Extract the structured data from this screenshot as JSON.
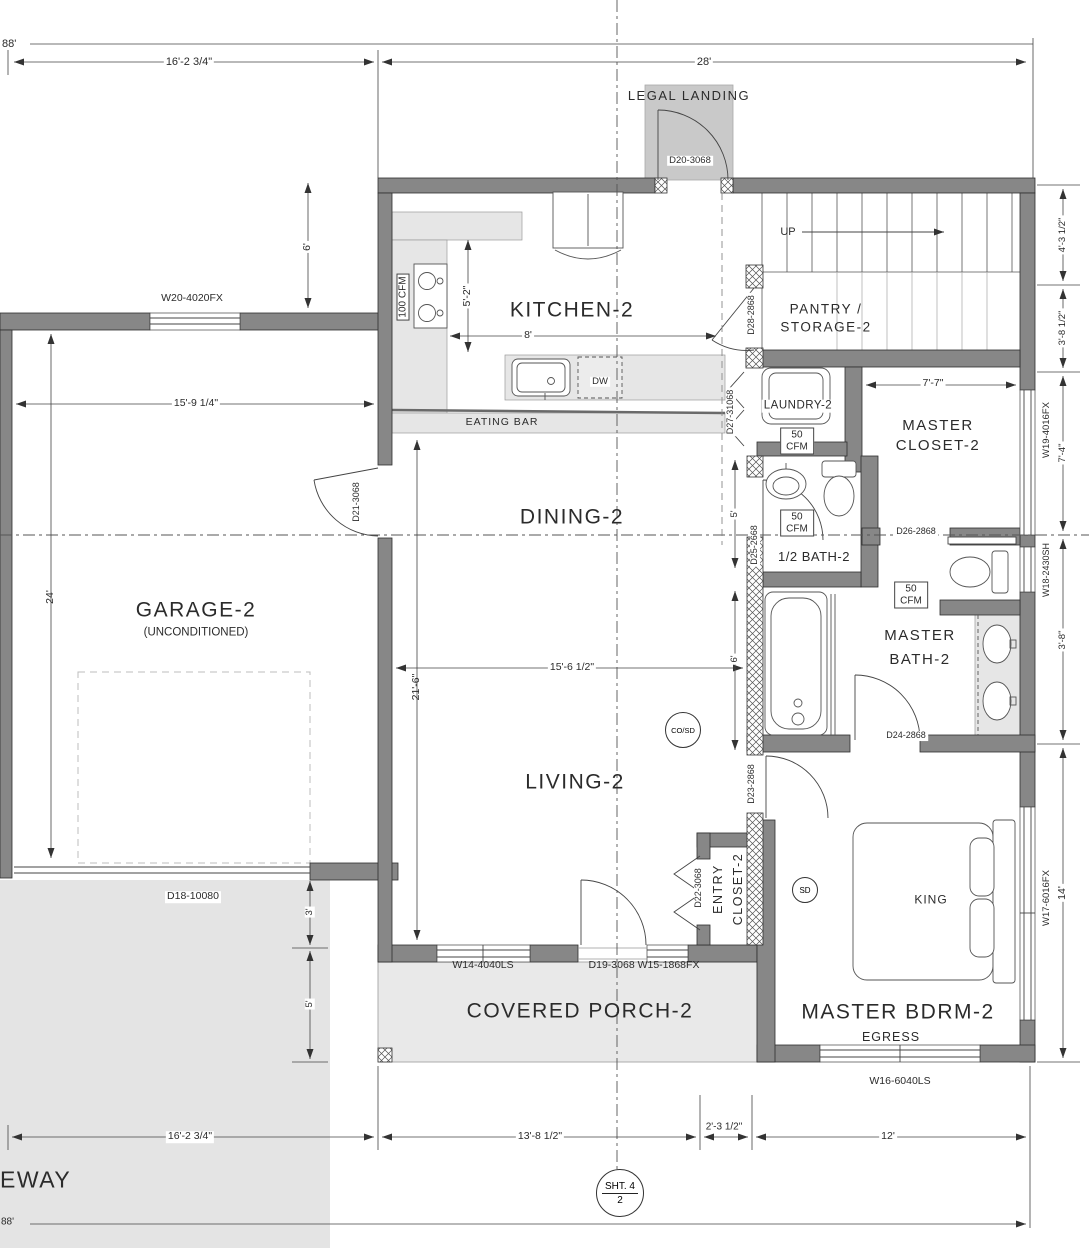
{
  "colors": {
    "wall": "#878787",
    "light_fill": "#e6e6e6",
    "landing_fill": "#c9c9c9",
    "driveway_fill": "#e4e4e4",
    "line": "#3c3c3c"
  },
  "rooms": {
    "kitchen": "KITCHEN-2",
    "pantry_line1": "PANTRY /",
    "pantry_line2": "STORAGE-2",
    "laundry": "LAUNDRY-2",
    "master_closet_line1": "MASTER",
    "master_closet_line2": "CLOSET-2",
    "half_bath": "1/2 BATH-2",
    "master_bath_line1": "MASTER",
    "master_bath_line2": "BATH-2",
    "dining": "DINING-2",
    "garage": "GARAGE-2",
    "garage_sub": "(UNCONDITIONED)",
    "living": "LIVING-2",
    "entry_closet_line1": "ENTRY",
    "entry_closet_line2": "CLOSET-2",
    "master_bdrm": "MASTER BDRM-2",
    "covered_porch": "COVERED PORCH-2",
    "legal_landing": "LEGAL LANDING",
    "driveway_partial": "EWAY"
  },
  "doors": {
    "d18": "D18-10080",
    "d19": "D19-3068",
    "d20": "D20-3068",
    "d21": "D21-3068",
    "d22": "D22-3068",
    "d23": "D23-2868",
    "d24": "D24-2868",
    "d25": "D25-2668",
    "d26": "D26-2868",
    "d27": "D27-31068",
    "d28": "D28-2868"
  },
  "windows": {
    "w14": "W14-4040LS",
    "w15": "W15-1868FX",
    "w16": "W16-6040LS",
    "w17": "W17-6016FX",
    "w18": "W18-2430SH",
    "w19": "W19-4016FX",
    "w20": "W20-4020FX",
    "porch_door_window": "D19-3068 W15-1868FX"
  },
  "dimensions": {
    "overall_top": "88'",
    "overall_bottom": "88'",
    "garage_width_top": "16'-2 3/4\"",
    "house_width_top": "28'",
    "kitchen_offset": "6'",
    "kitchen_depth": "5'-2\"",
    "kitchen_width": "8'",
    "garage_interior_width": "15'-9 1/4\"",
    "garage_depth": "24'",
    "living_length": "21'-6\"",
    "living_width": "15'-6 1/2\"",
    "half_bath_width": "5'",
    "hall_width": "6'",
    "closet_width": "7'-7\"",
    "right_1": "4'-3 1/2\"",
    "right_2": "3'-8 1/2\"",
    "right_3": "7'-4\"",
    "right_4": "3'-8\"",
    "right_5": "14'",
    "left_1": "3'",
    "left_2": "5'",
    "bottom_1": "16'-2 3/4\"",
    "bottom_2": "13'-8 1/2\"",
    "bottom_3": "2'-3 1/2\"",
    "bottom_4": "12'"
  },
  "annotations": {
    "up": "UP",
    "eating_bar": "EATING BAR",
    "dw": "DW",
    "king": "KING",
    "egress": "EGRESS",
    "cosd": "CO/SD",
    "sd": "SD",
    "cfm_100": "100 CFM",
    "cfm_50_line1": "50",
    "cfm_50_line2": "CFM"
  },
  "sheet_marker": {
    "line1": "SHT. 4",
    "line2": "2"
  }
}
